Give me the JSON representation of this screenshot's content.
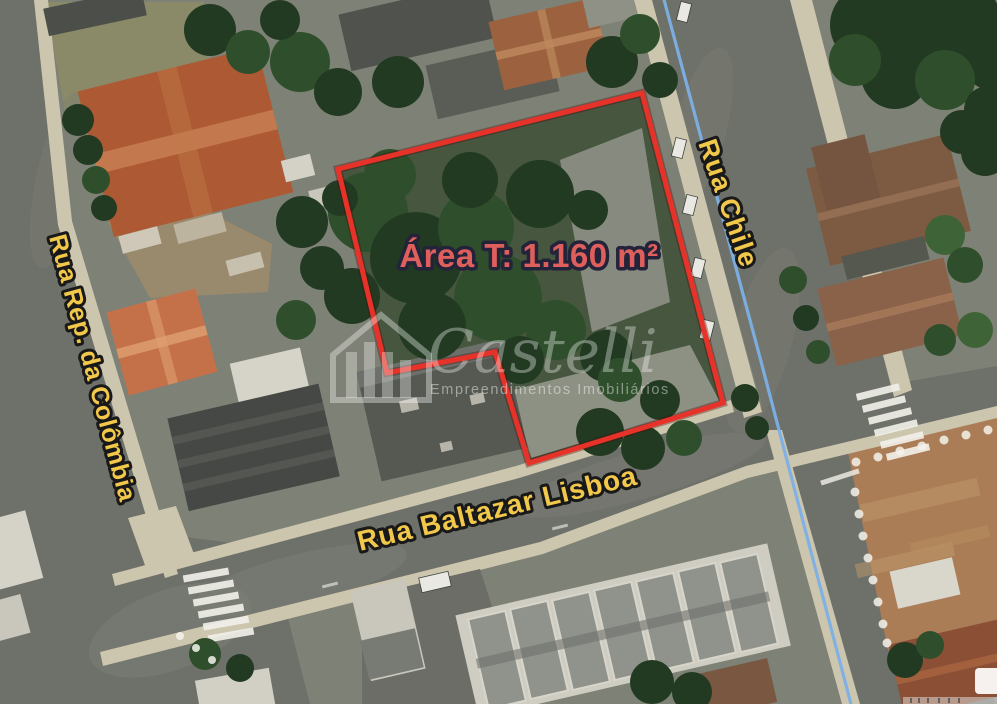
{
  "map": {
    "annotations": {
      "area_label": "Área T: 1.160 m²",
      "lot_outline_color": "#e63228",
      "area_label_color": "#df5f5c",
      "route_line_color": "#7cb0e6"
    },
    "streets": [
      {
        "id": "chile",
        "name": "Rua Chile"
      },
      {
        "id": "colombia",
        "name": "Rua Rep. da Colômbia"
      },
      {
        "id": "baltazar",
        "name": "Rua Baltazar Lisboa"
      }
    ],
    "street_label_color": "#f2c84b",
    "watermark": {
      "brand": "Castelli",
      "tagline": "Empreendimentos Imobiliários"
    }
  }
}
